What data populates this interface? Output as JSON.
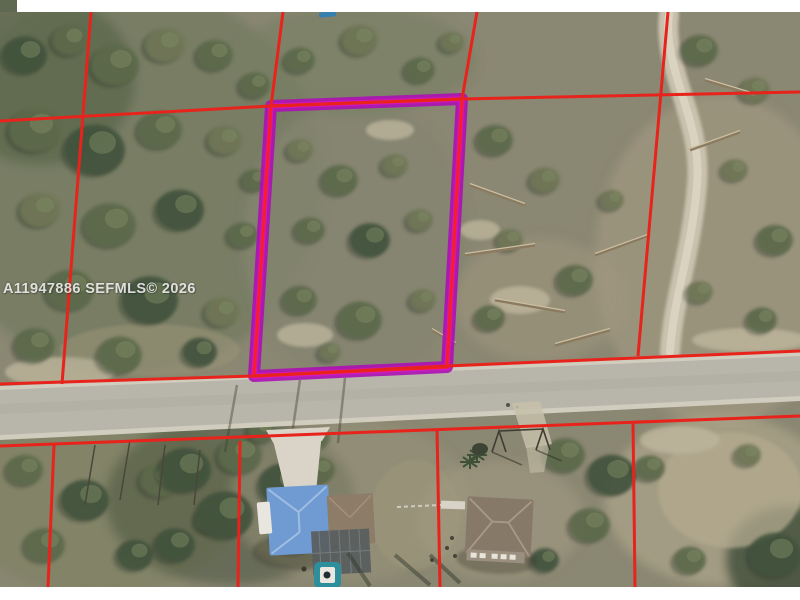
{
  "watermark": {
    "text": "A11947886 SEFMLS© 2026"
  },
  "photo": {
    "kind": "aerial-parcel-photo",
    "frame_color": "#ffffff"
  },
  "colors": {
    "frame": "#ffffff",
    "scrub_base": "#8a8772",
    "scrub_dense": "#6f7a5e",
    "tree_dark": "#42523e",
    "tree_mid": "#5d6b4c",
    "tree_olive": "#6f7757",
    "sand": "#c0b89f",
    "sand_light": "#d3cdbb",
    "road_pavement": "#b8b5ab",
    "road_shoulder": "#d0ccbe",
    "road_center": "#aeaba1",
    "driveway_concrete": "#d9d4c7",
    "driveway_sand": "#c6bfa9",
    "boundary_red": "#e8231c",
    "highlight_magenta": "#ad0fb4",
    "highlight_pink": "#e516c6",
    "highlight_core_red": "#f81e28",
    "blue_roof": "#6f9bd2",
    "blue_roof_ridge": "#9ebde2",
    "brown_roof": "#8d7c68",
    "gray_roof": "#867968",
    "gray_roof_ridge": "#a89a86",
    "enclosure_gray": "#585d5e",
    "pool_teal": "#2d8f9c",
    "pool_deck": "#e9e7df",
    "pool_center": "#1d2f33",
    "trailer_white": "#e8e6df",
    "fence_white": "#d8d3c8",
    "cyan_mark": "#2f7fb5",
    "trail_sand": "#d0c8b4"
  },
  "overlay": {
    "line_width": 3,
    "boundary_lines": [
      {
        "name": "north-boundary",
        "points": [
          [
            0,
            121
          ],
          [
            271,
            106
          ],
          [
            462,
            99
          ],
          [
            800,
            92
          ]
        ]
      },
      {
        "name": "street-north-boundary",
        "points": [
          [
            0,
            384
          ],
          [
            254,
            376
          ],
          [
            447,
            366
          ],
          [
            800,
            351
          ]
        ]
      },
      {
        "name": "street-south-boundary",
        "points": [
          [
            0,
            446
          ],
          [
            800,
            416
          ]
        ]
      },
      {
        "name": "west-lot-line-upper",
        "points": [
          [
            91,
            12
          ],
          [
            62,
            384
          ]
        ]
      },
      {
        "name": "subject-west-line-ext",
        "points": [
          [
            283,
            12
          ],
          [
            271,
            106
          ]
        ]
      },
      {
        "name": "subject-east-line-ext",
        "points": [
          [
            477,
            12
          ],
          [
            462,
            99
          ]
        ]
      },
      {
        "name": "east-lot-line-upper",
        "points": [
          [
            668,
            12
          ],
          [
            638,
            356
          ]
        ]
      },
      {
        "name": "south-lot-line-1",
        "points": [
          [
            54,
            445
          ],
          [
            48,
            587
          ]
        ]
      },
      {
        "name": "south-lot-line-2",
        "points": [
          [
            240,
            441
          ],
          [
            238,
            587
          ]
        ]
      },
      {
        "name": "south-lot-line-3",
        "points": [
          [
            437,
            429
          ],
          [
            440,
            587
          ]
        ]
      },
      {
        "name": "south-lot-line-4",
        "points": [
          [
            633,
            421
          ],
          [
            635,
            587
          ]
        ]
      }
    ],
    "highlight_parcel": {
      "name": "subject-lot-outline",
      "points": [
        [
          271,
          106
        ],
        [
          462,
          99
        ],
        [
          447,
          367
        ],
        [
          254,
          376
        ]
      ],
      "band_width": 12,
      "core_width": 3.2
    }
  }
}
